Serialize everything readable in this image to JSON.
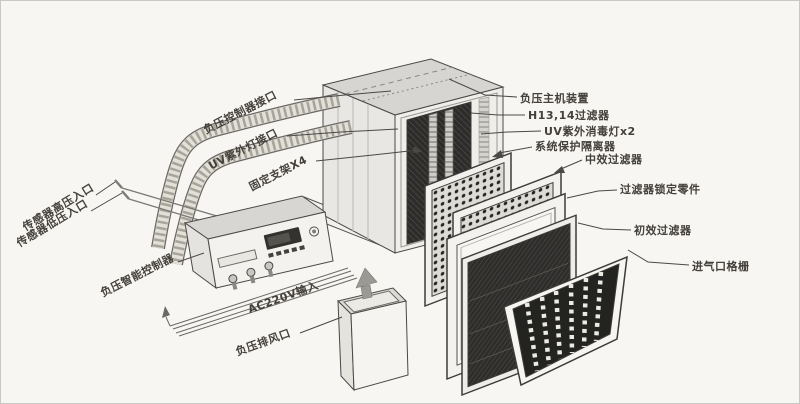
{
  "diagram_type": "exploded-view product diagram (negative pressure air purification unit)",
  "colors": {
    "background": "#f7f6f3",
    "outline": "#4a4947",
    "label_text": "#44403b",
    "machine_top": "#d6d5d1",
    "machine_side": "#e8e7e3",
    "machine_front": "#efeeea",
    "filter_dark": "#2d2c2a",
    "panel_frame": "#f2f1ed",
    "arrow_gray": "#9b9993"
  },
  "labels": {
    "left": [
      {
        "id": "neg-pressure-controller-port",
        "text": "负压控制器接口"
      },
      {
        "id": "uv-lamp-port",
        "text": "UV紫外灯接口"
      },
      {
        "id": "fixing-bracket-x4",
        "text": "固定支架X4"
      },
      {
        "id": "sensor-high-pressure-inlet",
        "text": "传感器高压入口"
      },
      {
        "id": "sensor-low-pressure-inlet",
        "text": "传感器低压入口"
      },
      {
        "id": "smart-controller",
        "text": "负压智能控制器"
      },
      {
        "id": "ac-220v-input",
        "text": "AC220V输入"
      },
      {
        "id": "neg-pressure-exhaust-outlet",
        "text": "负压排风口"
      }
    ],
    "right": [
      {
        "id": "main-unit",
        "text": "负压主机装置"
      },
      {
        "id": "hepa-filter",
        "text": "H13,14过滤器"
      },
      {
        "id": "uv-disinfection-lamp-x2",
        "text": "UV紫外消毒灯x2"
      },
      {
        "id": "system-protection-isolator",
        "text": "系统保护隔离器"
      },
      {
        "id": "medium-efficiency-filter",
        "text": "中效过滤器"
      },
      {
        "id": "filter-locking-parts",
        "text": "过滤器锁定零件"
      },
      {
        "id": "primary-efficiency-filter",
        "text": "初效过滤器"
      },
      {
        "id": "air-inlet-grille",
        "text": "进气口格栅"
      }
    ]
  }
}
